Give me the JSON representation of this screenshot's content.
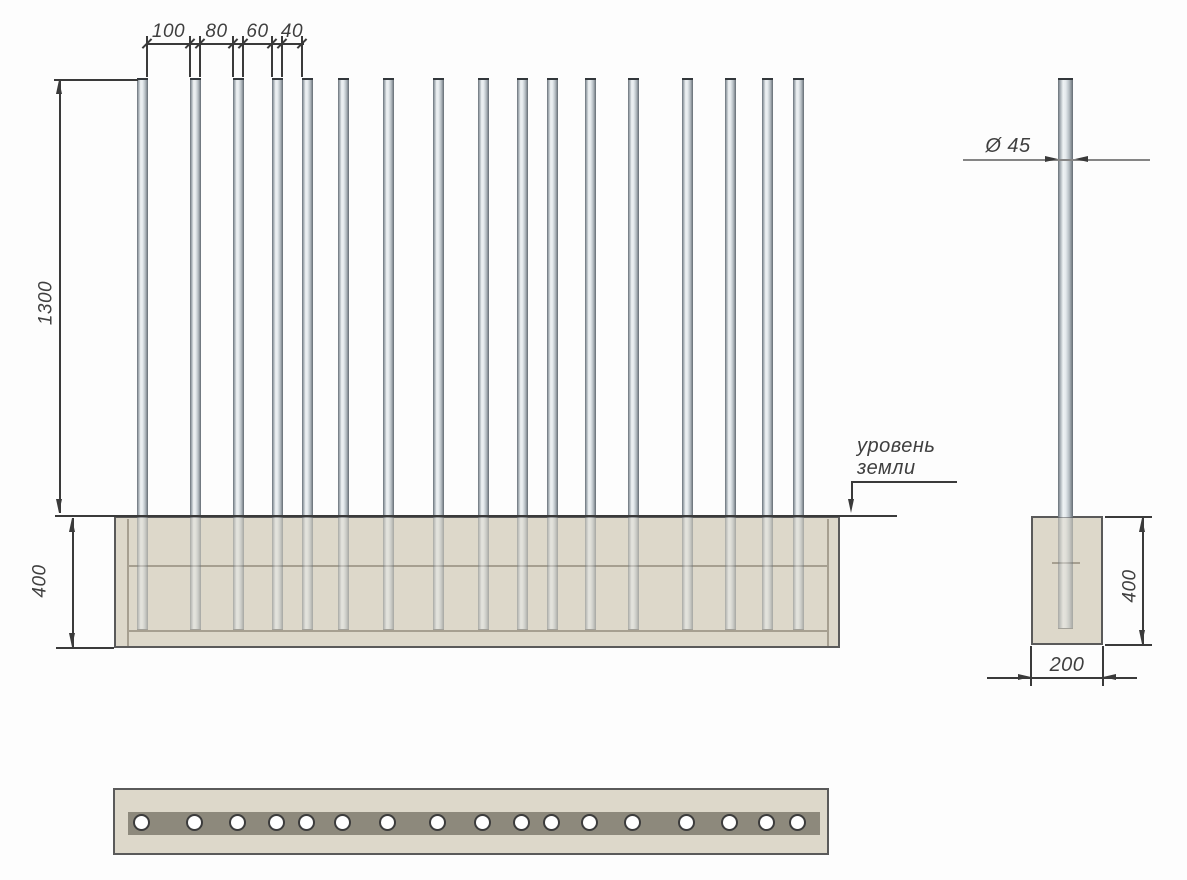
{
  "drawing": {
    "type": "technical-drawing",
    "subject": "metal post fence with strip foundation",
    "language": "ru"
  },
  "front_view": {
    "post_count": 17,
    "post_xs": [
      142,
      195,
      238,
      277,
      307,
      343,
      388,
      438,
      483,
      522,
      552,
      590,
      633,
      687,
      730,
      767,
      798
    ],
    "post_width": 11,
    "spacing_dims": [
      {
        "label": "100",
        "x1": 147,
        "x2": 190
      },
      {
        "label": "80",
        "x1": 200,
        "x2": 233
      },
      {
        "label": "60",
        "x1": 243,
        "x2": 272
      },
      {
        "label": "40",
        "x1": 282,
        "x2": 302
      }
    ],
    "height_dim_label": "1300",
    "embed_dim_label": "400",
    "ground_label_line1": "уровень",
    "ground_label_line2": "земли"
  },
  "side_view": {
    "diameter_dim_label": "Ø 45",
    "embed_dim_label": "400",
    "width_dim_label": "200"
  },
  "plan_view": {
    "hole_count": 17,
    "hole_xs": [
      142,
      195,
      238,
      277,
      307,
      343,
      388,
      438,
      483,
      522,
      552,
      590,
      633,
      687,
      730,
      767,
      798
    ],
    "hole_y": 823
  },
  "colors": {
    "background": "#fdfdfd",
    "line": "#3a3a3a",
    "dim_gray": "#858585",
    "text": "#3f3f3f",
    "foundation_fill": "#ddd8ca",
    "foundation_border": "#5a5a5a",
    "foundation_inner_line": "#a69f90",
    "plan_band": "#8d897c",
    "post_metal_light": "#eef2f4",
    "post_metal_dark": "#676f76"
  }
}
